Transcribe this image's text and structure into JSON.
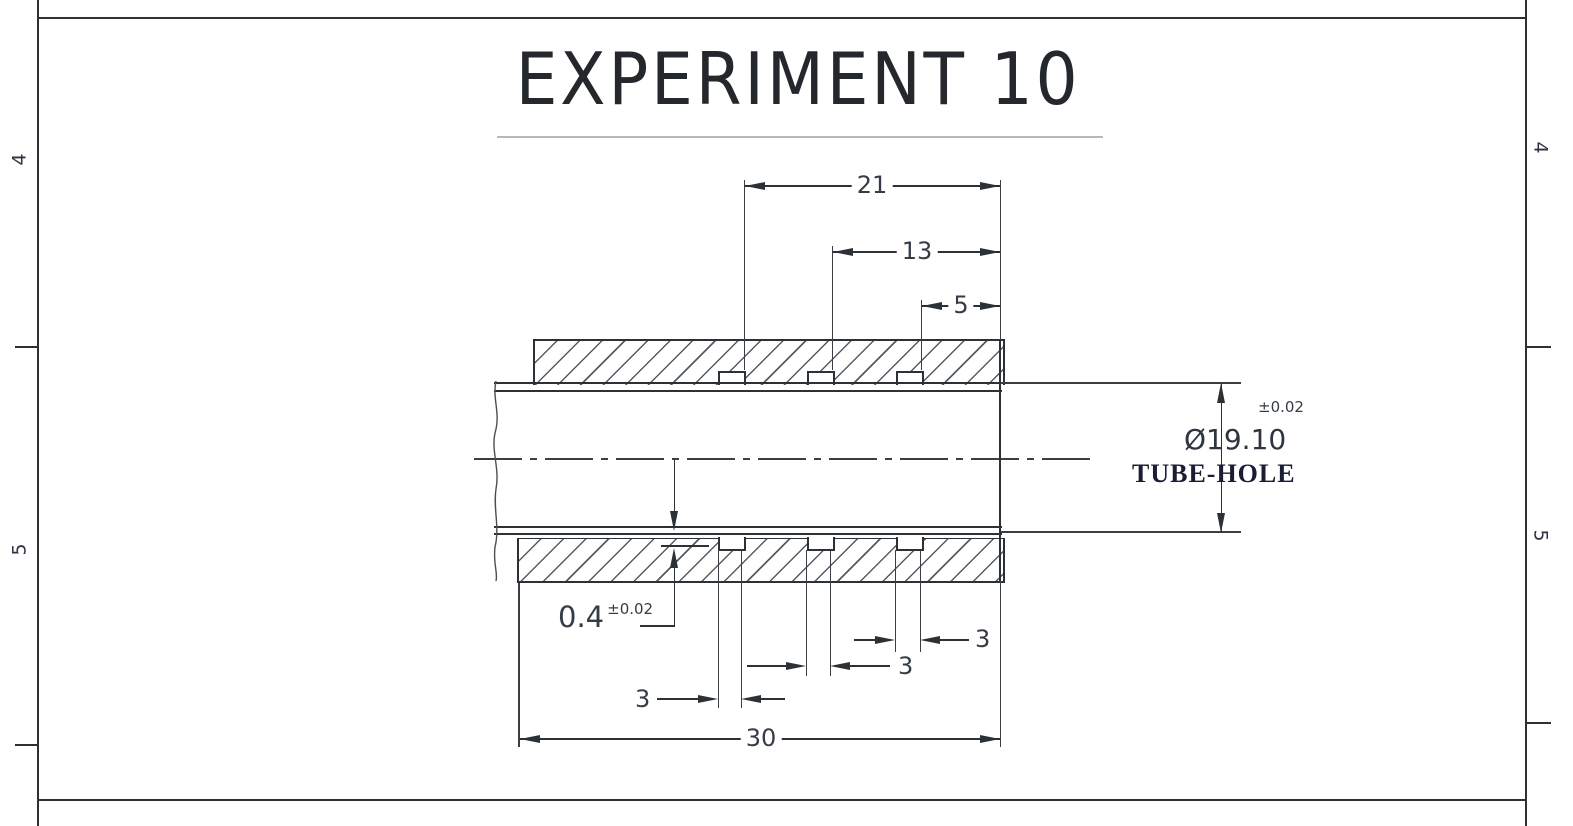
{
  "title": "EXPERIMENT 10",
  "border": {
    "zone_left_top": "4",
    "zone_left_bottom": "5",
    "zone_right_top": "4",
    "zone_right_bottom": "5"
  },
  "dims": {
    "d21": "21",
    "d13": "13",
    "d5": "5",
    "d30": "30",
    "groove_w1": "3",
    "groove_w2": "3",
    "groove_w3": "3",
    "land_value": "0.4",
    "land_tol": "±0.02",
    "hole_tol": "±0.02",
    "hole_dia": "Ø19.10",
    "hole_label": "TUBE-HOLE"
  },
  "colors": {
    "line": "#2c3136",
    "dim_text": "#363c46",
    "tube_hole_label": "#1a1d33",
    "title_underline": "#b8b8b8"
  }
}
